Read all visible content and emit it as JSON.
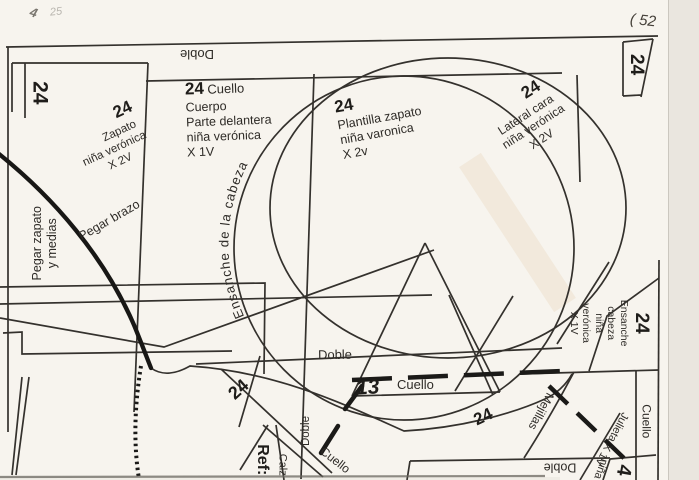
{
  "paper": {
    "bg": "#f7f4ee",
    "ink": "#2e2b27",
    "edge": "#eae6df"
  },
  "handwriting": {
    "top_left_a": "4",
    "top_left_b": "25",
    "top_right": "( 52"
  },
  "labels": {
    "doble_top": "Doble",
    "size_left": "24",
    "zapato": {
      "num": "24",
      "l1": "Zapato",
      "l2": "niña verónica",
      "l3": "X 2V"
    },
    "cuerpo": {
      "num": "24",
      "head": "Cuello",
      "l1": "Cuerpo",
      "l2": "Parte delantera",
      "l3": "niña verónica",
      "l4": "X 1V"
    },
    "plantilla": {
      "num": "24",
      "l1": "Plantilla zapato",
      "l2": "niña varonica",
      "l3": "X 2v"
    },
    "lateral": {
      "num": "24",
      "l1": "Lateral cara",
      "l2": "niña verónica",
      "l3": "X 2V"
    },
    "size_top_right": "24",
    "ensanche_arc": "Ensanche de la cabeza",
    "pegar_brazo": "Pegar brazo",
    "pegar_zapato": {
      "l1": "Pegar zapato",
      "l2": "y medias"
    },
    "ensanche_piece": {
      "num": "24",
      "l1": "Ensanche",
      "l2": "cabeza",
      "l3": "niña",
      "l4": "verónica",
      "l5": "X 1V"
    },
    "doble_mid": "Doble",
    "cuello_mid": {
      "num": "13",
      "label": "Cuello"
    },
    "num24_triangle": "24",
    "num24_left": "24",
    "doble_vert": "Doble",
    "ref": "Ref:",
    "calz": "Calz",
    "cuello_diag": "Cuello",
    "mejillas": "Mejillas",
    "julieta": "Julieta X 1V",
    "nina": "niña",
    "cuello_right": "Cuello",
    "doble_bottom": "Doble",
    "num4": "4"
  }
}
